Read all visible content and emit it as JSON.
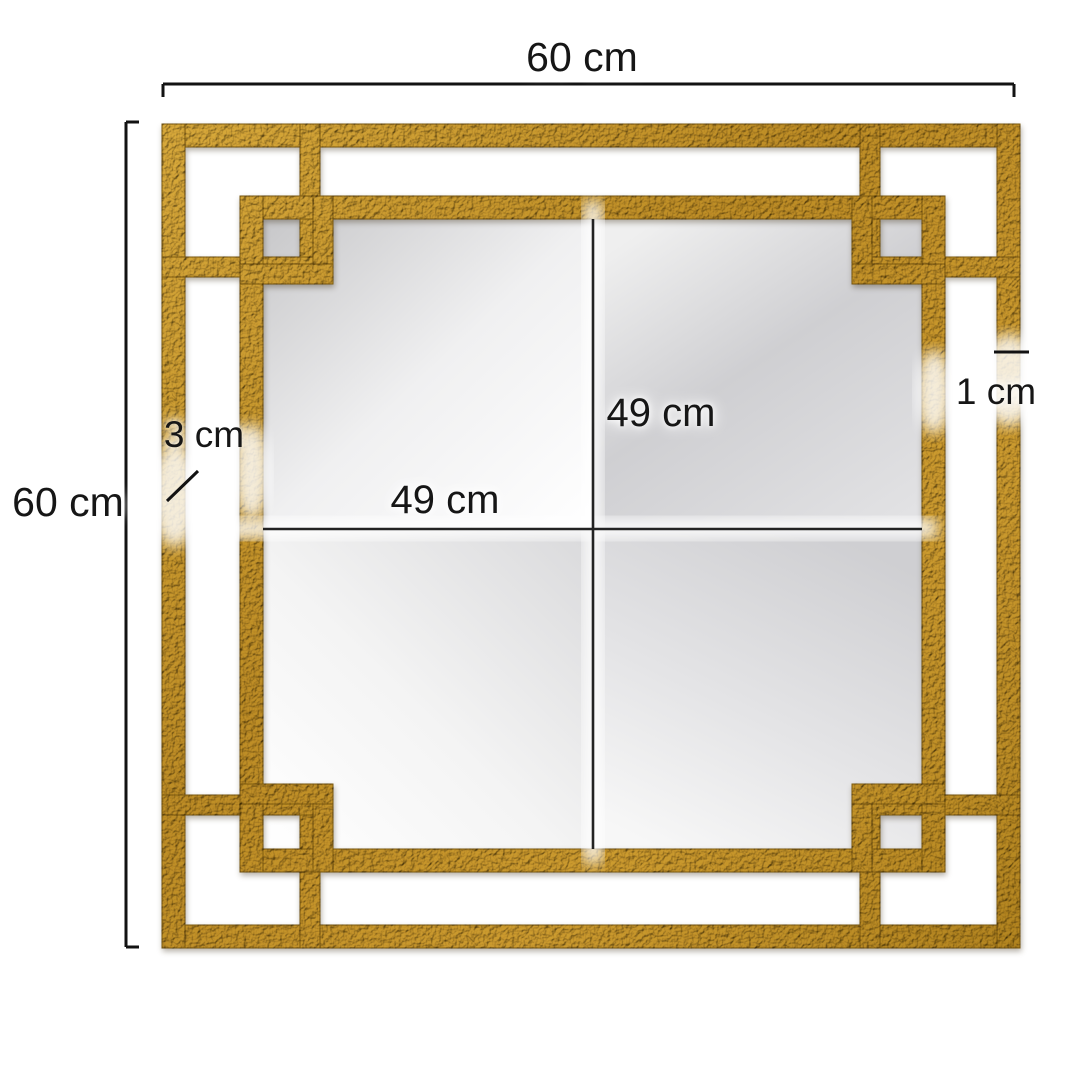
{
  "diagram": {
    "type": "product-dimension-diagram",
    "subject": "square gold fretwork wall mirror",
    "labels": {
      "overall_width": "60 cm",
      "overall_height": "60 cm",
      "glass_width": "49 cm",
      "glass_height": "49 cm",
      "frame_offset": "3 cm",
      "bar_thickness": "1 cm"
    },
    "colors": {
      "frame_gold": "#c49a33",
      "frame_gold_dark": "#8a6a1c",
      "frame_gold_light": "#e9cb6e",
      "glass_gray": "#d2d2d4",
      "annotation_line": "#121212",
      "background": "#ffffff"
    }
  }
}
